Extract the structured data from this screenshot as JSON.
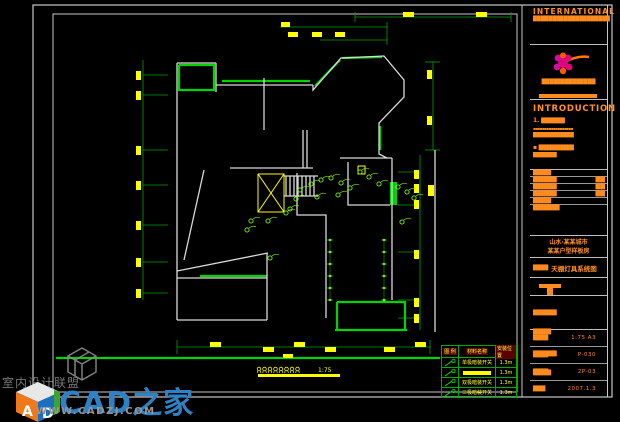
{
  "title_block": {
    "company_en": "INTERNATIONAL",
    "company_cn_top": "████████████████████",
    "company_cn_mid": "██████████████",
    "logo": "flower-logo",
    "introduction_heading": "INTRODUCTION",
    "item1_no": "1.",
    "item1_bar": "████████",
    "item1_line": "▪▪▪▪▪▪▪▪▪▪▪▪▪▪▪▪▪▪",
    "item1_bar2": "██████████████",
    "item2_no": "▪",
    "item2_bar": "████████████",
    "item2_bar2": "████████",
    "form_rows": [
      {
        "left": "██████",
        "right": ""
      },
      {
        "left": "████████",
        "right": "███"
      },
      {
        "left": "████████",
        "right": "███"
      },
      {
        "left": "████████",
        "right": "███"
      },
      {
        "left": "██████",
        "right": ""
      },
      {
        "left": "█████████",
        "right": ""
      }
    ],
    "project_line1": "山水·某某城市",
    "project_line2": "某某户型样板房",
    "title_label": "█████",
    "drawing_title": "天棚灯具系统图",
    "double_bars": [
      "████████",
      "██████",
      "████████",
      "██████"
    ],
    "values": [
      {
        "label": "█████",
        "value": "1:75 A3"
      },
      {
        "label": "█████",
        "value": "P-030"
      },
      {
        "label": "█████",
        "value": "2P-03"
      },
      {
        "label": "████",
        "value": "2007.1.3"
      }
    ]
  },
  "legend": {
    "header": [
      "图 例",
      "材料名称",
      "安装位置"
    ],
    "rows": [
      {
        "symbol": "switch-icon",
        "name": "单极暗装开关",
        "loc": "1.3m",
        "bar": false
      },
      {
        "symbol": "switch-icon",
        "name": "",
        "loc": "1.3m",
        "bar": true
      },
      {
        "symbol": "switch-icon",
        "name": "双极暗装开关",
        "loc": "1.3m",
        "bar": false
      },
      {
        "symbol": "switch-icon",
        "name": "三极暗装开关",
        "loc": "1.3m",
        "bar": false
      }
    ]
  },
  "figure_title": {
    "scale": "1:75",
    "symbol_count": 8
  },
  "watermark": {
    "forum_name": "室内设计联盟",
    "site_name": "CAD之家",
    "site_url": "WWW.CADZJ.COM",
    "cube_letter_left": "A",
    "cube_letter_right": "D"
  },
  "colors": {
    "wall": "#d9d9d9",
    "green": "#00d400",
    "dim": "#00a000",
    "yellow": "#ffff00",
    "orange": "#ff8a1e",
    "light": "#7cfc00",
    "border": "#c8c8c8",
    "blue_brand": "#2e82c4"
  },
  "plan": {
    "borders": {
      "outer": [
        33,
        5,
        579,
        392
      ],
      "inner": [
        53,
        14,
        464,
        378
      ],
      "title_left_line": 522
    },
    "walls": [
      [
        [
          177,
          63
        ],
        [
          177,
          320
        ]
      ],
      [
        [
          177,
          63
        ],
        [
          216,
          63
        ]
      ],
      [
        [
          216,
          63
        ],
        [
          216,
          92
        ]
      ],
      [
        [
          216,
          85
        ],
        [
          313,
          85
        ]
      ],
      [
        [
          313,
          85
        ],
        [
          313,
          90
        ],
        [
          341,
          58
        ],
        [
          384,
          56
        ],
        [
          404,
          80
        ],
        [
          404,
          97
        ],
        [
          379,
          123
        ],
        [
          379,
          154
        ],
        [
          387,
          158
        ]
      ],
      [
        [
          264,
          78
        ],
        [
          264,
          130
        ]
      ],
      [
        [
          230,
          168
        ],
        [
          313,
          168
        ]
      ],
      [
        [
          297,
          173
        ],
        [
          297,
          215
        ],
        [
          326,
          215
        ],
        [
          326,
          275
        ]
      ],
      [
        [
          340,
          158
        ],
        [
          392,
          158
        ]
      ],
      [
        [
          348,
          162
        ],
        [
          348,
          205
        ],
        [
          390,
          205
        ]
      ],
      [
        [
          392,
          158
        ],
        [
          392,
          300
        ]
      ],
      [
        [
          204,
          170
        ],
        [
          184,
          260
        ]
      ],
      [
        [
          177,
          271
        ],
        [
          268,
          253
        ]
      ],
      [
        [
          177,
          278
        ],
        [
          267,
          278
        ]
      ],
      [
        [
          267,
          253
        ],
        [
          267,
          320
        ]
      ],
      [
        [
          177,
          320
        ],
        [
          267,
          320
        ]
      ],
      [
        [
          326,
          275
        ],
        [
          326,
          318
        ]
      ],
      [
        [
          303,
          130
        ],
        [
          303,
          168
        ]
      ],
      [
        [
          307,
          130
        ],
        [
          307,
          168
        ]
      ],
      [
        [
          284,
          176
        ],
        [
          318,
          176
        ]
      ],
      [
        [
          284,
          196
        ],
        [
          318,
          196
        ]
      ],
      [
        [
          286,
          176
        ],
        [
          286,
          196
        ]
      ],
      [
        [
          290,
          176
        ],
        [
          290,
          196
        ]
      ],
      [
        [
          294,
          176
        ],
        [
          294,
          196
        ]
      ],
      [
        [
          298,
          176
        ],
        [
          298,
          196
        ]
      ],
      [
        [
          302,
          176
        ],
        [
          302,
          196
        ]
      ],
      [
        [
          306,
          176
        ],
        [
          306,
          196
        ]
      ],
      [
        [
          310,
          176
        ],
        [
          310,
          196
        ]
      ],
      [
        [
          314,
          176
        ],
        [
          314,
          196
        ]
      ],
      [
        [
          435,
          150
        ],
        [
          435,
          332
        ]
      ]
    ],
    "green_lines": [
      [
        [
          179,
          65
        ],
        [
          214,
          65
        ],
        [
          214,
          90
        ],
        [
          179,
          90
        ],
        [
          179,
          65
        ]
      ],
      [
        [
          222,
          81
        ],
        [
          310,
          81
        ]
      ],
      [
        [
          315,
          86
        ],
        [
          340,
          60
        ]
      ],
      [
        [
          342,
          58
        ],
        [
          382,
          57
        ]
      ],
      [
        [
          380,
          126
        ],
        [
          380,
          150
        ]
      ],
      [
        [
          200,
          276
        ],
        [
          267,
          276
        ]
      ],
      [
        [
          337,
          302
        ],
        [
          405,
          302
        ],
        [
          405,
          330
        ]
      ],
      [
        [
          337,
          302
        ],
        [
          337,
          330
        ]
      ],
      [
        [
          335,
          330
        ],
        [
          407,
          330
        ]
      ],
      [
        [
          56,
          358
        ],
        [
          440,
          358
        ]
      ]
    ],
    "green_rects": [
      [
        390,
        182,
        7,
        23
      ]
    ],
    "dims": [
      [
        [
          355,
          17
        ],
        [
          511,
          17
        ]
      ],
      [
        [
          355,
          12
        ],
        [
          355,
          22
        ]
      ],
      [
        [
          511,
          12
        ],
        [
          511,
          22
        ]
      ],
      [
        [
          280,
          27
        ],
        [
          387,
          27
        ]
      ],
      [
        [
          320,
          40
        ],
        [
          387,
          40
        ]
      ],
      [
        [
          387,
          22
        ],
        [
          387,
          45
        ]
      ],
      [
        [
          143,
          60
        ],
        [
          143,
          300
        ]
      ],
      [
        [
          143,
          75
        ],
        [
          168,
          75
        ]
      ],
      [
        [
          143,
          95
        ],
        [
          168,
          95
        ]
      ],
      [
        [
          143,
          150
        ],
        [
          168,
          150
        ]
      ],
      [
        [
          143,
          185
        ],
        [
          168,
          185
        ]
      ],
      [
        [
          143,
          225
        ],
        [
          168,
          225
        ]
      ],
      [
        [
          143,
          262
        ],
        [
          168,
          262
        ]
      ],
      [
        [
          143,
          293
        ],
        [
          168,
          293
        ]
      ],
      [
        [
          433,
          62
        ],
        [
          433,
          150
        ]
      ],
      [
        [
          425,
          62
        ],
        [
          440,
          62
        ]
      ],
      [
        [
          425,
          150
        ],
        [
          440,
          150
        ]
      ],
      [
        [
          420,
          155
        ],
        [
          420,
          330
        ]
      ],
      [
        [
          398,
          172
        ],
        [
          420,
          172
        ]
      ],
      [
        [
          398,
          205
        ],
        [
          420,
          205
        ]
      ],
      [
        [
          398,
          252
        ],
        [
          420,
          252
        ]
      ],
      [
        [
          398,
          300
        ],
        [
          420,
          300
        ]
      ],
      [
        [
          398,
          318
        ],
        [
          420,
          318
        ]
      ],
      [
        [
          177,
          347
        ],
        [
          430,
          347
        ]
      ],
      [
        [
          177,
          340
        ],
        [
          177,
          354
        ]
      ],
      [
        [
          430,
          340
        ],
        [
          430,
          354
        ]
      ]
    ],
    "dim_labels": [
      [
        403,
        12,
        11,
        5
      ],
      [
        476,
        12,
        11,
        5
      ],
      [
        281,
        22,
        9,
        5
      ],
      [
        288,
        32,
        10,
        5
      ],
      [
        312,
        32,
        10,
        5
      ],
      [
        335,
        32,
        10,
        5
      ],
      [
        136,
        71,
        5,
        9
      ],
      [
        136,
        91,
        5,
        9
      ],
      [
        136,
        146,
        5,
        9
      ],
      [
        136,
        181,
        5,
        9
      ],
      [
        136,
        221,
        5,
        9
      ],
      [
        136,
        258,
        5,
        9
      ],
      [
        136,
        289,
        5,
        9
      ],
      [
        427,
        70,
        5,
        9
      ],
      [
        427,
        116,
        5,
        9
      ],
      [
        414,
        170,
        5,
        9
      ],
      [
        414,
        184,
        5,
        9
      ],
      [
        414,
        200,
        5,
        9
      ],
      [
        414,
        250,
        5,
        9
      ],
      [
        414,
        298,
        5,
        9
      ],
      [
        414,
        314,
        5,
        9
      ],
      [
        428,
        185,
        6,
        11
      ],
      [
        210,
        342,
        11,
        5
      ],
      [
        263,
        347,
        11,
        5
      ],
      [
        294,
        342,
        11,
        5
      ],
      [
        325,
        347,
        11,
        5
      ],
      [
        384,
        347,
        11,
        5
      ],
      [
        415,
        342,
        11,
        5
      ],
      [
        283,
        354,
        10,
        4
      ]
    ],
    "yellow_lines": [
      [
        [
          258,
          174
        ],
        [
          284,
          174
        ],
        [
          284,
          212
        ],
        [
          258,
          212
        ],
        [
          258,
          174
        ]
      ],
      [
        [
          258,
          174
        ],
        [
          284,
          212
        ]
      ],
      [
        [
          258,
          212
        ],
        [
          284,
          174
        ]
      ],
      [
        [
          358,
          166
        ],
        [
          365,
          166
        ],
        [
          365,
          174
        ],
        [
          358,
          174
        ],
        [
          358,
          166
        ]
      ]
    ],
    "yellow_bar": [
      258,
      374,
      82,
      3
    ],
    "lights": [
      [
        300,
        190
      ],
      [
        311,
        184
      ],
      [
        321,
        180
      ],
      [
        331,
        178
      ],
      [
        341,
        183
      ],
      [
        350,
        188
      ],
      [
        296,
        199
      ],
      [
        286,
        213
      ],
      [
        268,
        221
      ],
      [
        251,
        221
      ],
      [
        360,
        172
      ],
      [
        369,
        177
      ],
      [
        379,
        184
      ],
      [
        398,
        187
      ],
      [
        407,
        192
      ],
      [
        414,
        198
      ],
      [
        402,
        222
      ],
      [
        270,
        258
      ],
      [
        290,
        209
      ],
      [
        247,
        230
      ],
      [
        317,
        197
      ],
      [
        338,
        195
      ]
    ],
    "chains": [
      {
        "x": 330,
        "ys": [
          240,
          252,
          264,
          276,
          288,
          300
        ]
      },
      {
        "x": 384,
        "ys": [
          240,
          252,
          264,
          276,
          288,
          300
        ]
      }
    ],
    "symbols_row": {
      "x": 259,
      "y": 369,
      "step": 5.5
    }
  }
}
